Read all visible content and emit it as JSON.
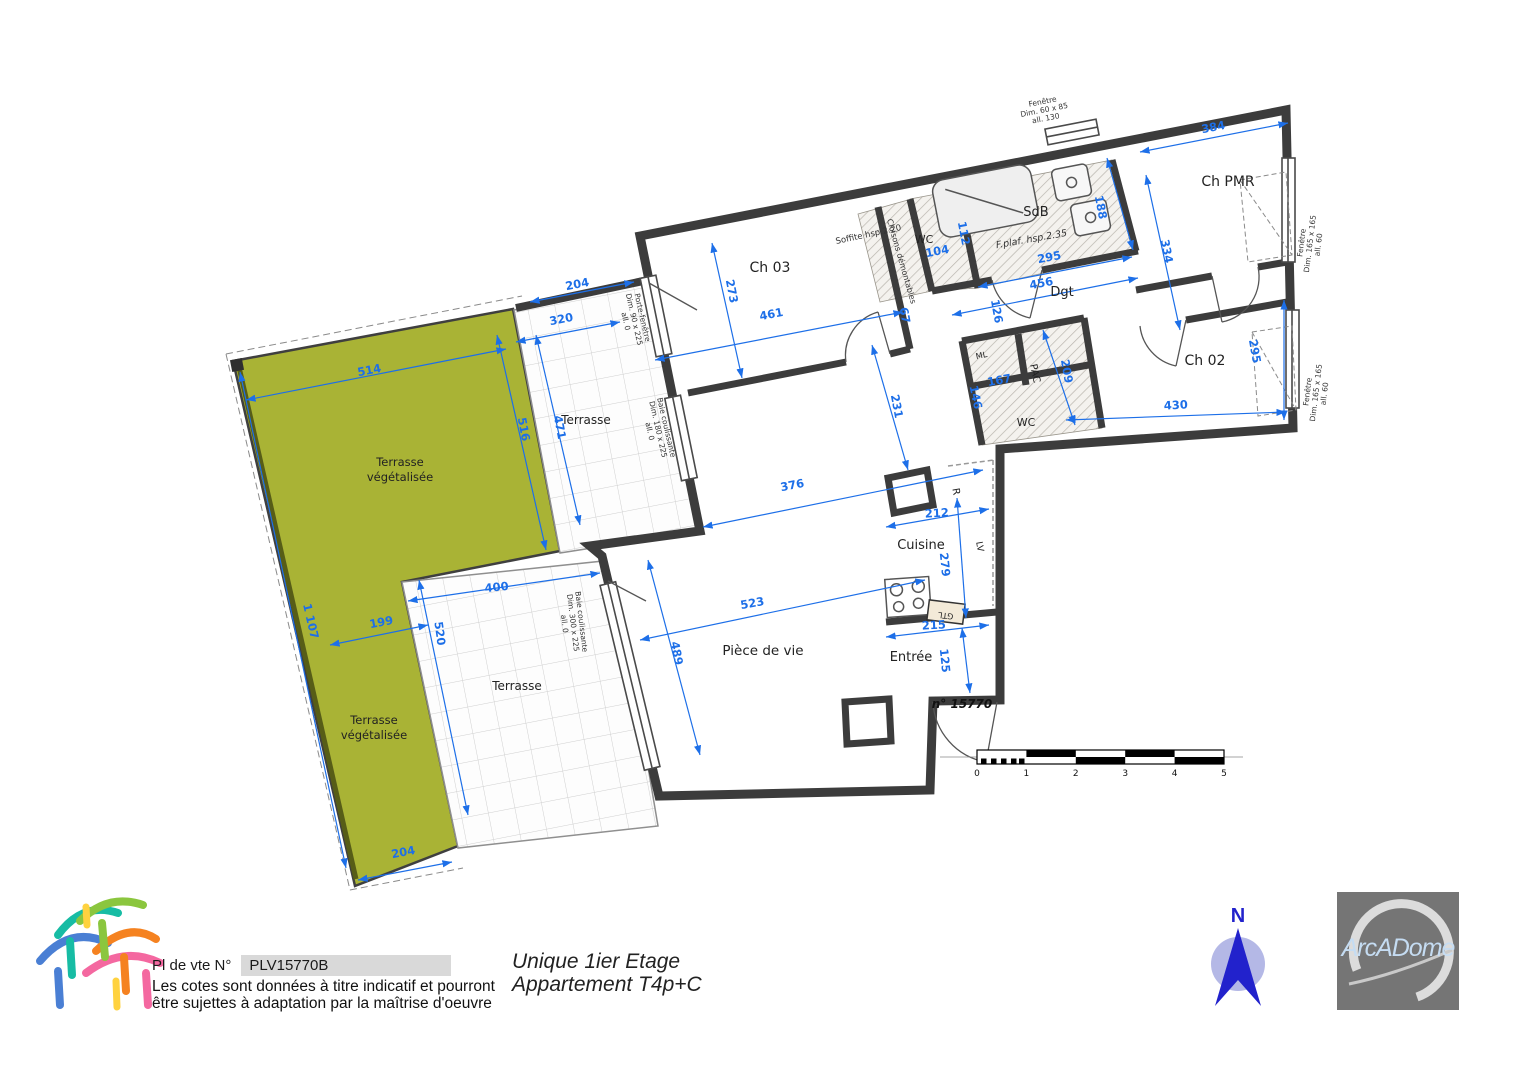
{
  "colors": {
    "dimension_blue": "#1d6fe8",
    "wall_dark": "#3c3c3c",
    "terrace_green": "#a9b335",
    "logo_gray": "#757575"
  },
  "footer": {
    "plan_ref_label": "Pl de vte N°",
    "plan_ref_value": "PLV15770B",
    "disclaimer_line1": "Les cotes sont données à titre indicatif et pourront",
    "disclaimer_line2": "être sujettes à adaptation par la  maîtrise d'oeuvre",
    "floor_title": "Unique 1ier Etage",
    "apartment_title": "Appartement  T4p+C",
    "north_label": "N",
    "brand_text": "ArcADome"
  },
  "plan": {
    "unit_number": "n° 15770",
    "rooms": [
      {
        "label": "Ch 03",
        "x": 770,
        "y": 272,
        "rot": 0,
        "size": 14
      },
      {
        "label": "Ch PMR",
        "x": 1228,
        "y": 186,
        "rot": 0,
        "size": 14
      },
      {
        "label": "Ch 02",
        "x": 1205,
        "y": 365,
        "rot": 0,
        "size": 14
      },
      {
        "label": "SdB",
        "x": 1036,
        "y": 216,
        "rot": 0,
        "size": 13
      },
      {
        "label": "Dgt",
        "x": 1062,
        "y": 296,
        "rot": 0,
        "size": 13
      },
      {
        "label": "WC",
        "x": 924,
        "y": 243,
        "rot": 0,
        "size": 11
      },
      {
        "label": "WC",
        "x": 1026,
        "y": 426,
        "rot": 0,
        "size": 11
      },
      {
        "label": "PAC",
        "x": 1032,
        "y": 374,
        "rot": 78,
        "size": 10
      },
      {
        "label": "ML",
        "x": 982,
        "y": 358,
        "rot": -12,
        "size": 8
      },
      {
        "label": "Cuisine",
        "x": 921,
        "y": 549,
        "rot": 0,
        "size": 13
      },
      {
        "label": "Pièce de vie",
        "x": 763,
        "y": 655,
        "rot": 0,
        "size": 13.5
      },
      {
        "label": "Entrée",
        "x": 911,
        "y": 661,
        "rot": 0,
        "size": 13
      },
      {
        "label": "Terrasse",
        "x": 586,
        "y": 424,
        "rot": 0,
        "size": 12
      },
      {
        "label": "Terrasse",
        "x": 517,
        "y": 690,
        "rot": 0,
        "size": 12
      },
      {
        "label": "Terrasse",
        "x": 400,
        "y": 466,
        "rot": 0,
        "size": 11.5
      },
      {
        "label": "végétalisée",
        "x": 400,
        "y": 481,
        "rot": 0,
        "size": 11.5
      },
      {
        "label": "Terrasse",
        "x": 374,
        "y": 724,
        "rot": 0,
        "size": 11.5
      },
      {
        "label": "végétalisée",
        "x": 374,
        "y": 739,
        "rot": 0,
        "size": 11.5
      },
      {
        "label": "R",
        "x": 953,
        "y": 492,
        "rot": 80,
        "size": 10
      },
      {
        "label": "LV",
        "x": 977,
        "y": 547,
        "rot": 80,
        "size": 9
      },
      {
        "label": "GTL",
        "x": 946,
        "y": 613,
        "rot": 187,
        "size": 8
      }
    ],
    "dimensions": [
      {
        "label": "384",
        "x": 1214,
        "y": 131,
        "rot": -11,
        "line": [
          1140,
          152,
          1288,
          123
        ]
      },
      {
        "label": "334",
        "x": 1163,
        "y": 252,
        "rot": 79,
        "line": [
          1146,
          175,
          1180,
          330
        ]
      },
      {
        "label": "295",
        "x": 1251,
        "y": 352,
        "rot": 80,
        "line": [
          1284,
          300,
          1284,
          420
        ]
      },
      {
        "label": "430",
        "x": 1176,
        "y": 409,
        "rot": -3,
        "line": [
          1066,
          420,
          1286,
          412
        ]
      },
      {
        "label": "209",
        "x": 1063,
        "y": 372,
        "rot": 80,
        "line": [
          1043,
          330,
          1075,
          425
        ]
      },
      {
        "label": "167",
        "x": 1000,
        "y": 384,
        "rot": -10,
        "line": null
      },
      {
        "label": "146",
        "x": 972,
        "y": 398,
        "rot": 78,
        "line": null
      },
      {
        "label": "456",
        "x": 1042,
        "y": 287,
        "rot": -11,
        "line": [
          952,
          315,
          1138,
          278
        ]
      },
      {
        "label": "126",
        "x": 993,
        "y": 312,
        "rot": 80,
        "line": null
      },
      {
        "label": "295",
        "x": 1050,
        "y": 261,
        "rot": -11,
        "line": [
          978,
          287,
          1132,
          257
        ]
      },
      {
        "label": "188",
        "x": 1097,
        "y": 208,
        "rot": 79,
        "line": [
          1107,
          158,
          1133,
          250
        ]
      },
      {
        "label": "104",
        "x": 938,
        "y": 255,
        "rot": -11,
        "line": null
      },
      {
        "label": "112",
        "x": 960,
        "y": 234,
        "rot": 79,
        "line": null
      },
      {
        "label": "67",
        "x": 901,
        "y": 316,
        "rot": 79,
        "line": null
      },
      {
        "label": "461",
        "x": 772,
        "y": 318,
        "rot": -11,
        "line": [
          655,
          360,
          903,
          312
        ]
      },
      {
        "label": "273",
        "x": 728,
        "y": 292,
        "rot": 79,
        "line": [
          712,
          243,
          742,
          378
        ]
      },
      {
        "label": "231",
        "x": 893,
        "y": 407,
        "rot": 79,
        "line": [
          872,
          345,
          908,
          470
        ]
      },
      {
        "label": "376",
        "x": 793,
        "y": 489,
        "rot": -11,
        "line": [
          703,
          527,
          983,
          470
        ]
      },
      {
        "label": "212",
        "x": 937,
        "y": 517,
        "rot": -3,
        "line": [
          886,
          527,
          989,
          509
        ]
      },
      {
        "label": "279",
        "x": 941,
        "y": 565,
        "rot": 84,
        "line": [
          957,
          498,
          966,
          618
        ]
      },
      {
        "label": "523",
        "x": 753,
        "y": 607,
        "rot": -10,
        "line": [
          640,
          640,
          925,
          580
        ]
      },
      {
        "label": "489",
        "x": 673,
        "y": 654,
        "rot": 79,
        "line": [
          648,
          560,
          700,
          755
        ]
      },
      {
        "label": "215",
        "x": 934,
        "y": 629,
        "rot": -3,
        "line": [
          886,
          637,
          989,
          625
        ]
      },
      {
        "label": "125",
        "x": 941,
        "y": 661,
        "rot": 84,
        "line": [
          962,
          628,
          970,
          693
        ]
      },
      {
        "label": "204",
        "x": 578,
        "y": 288,
        "rot": -11,
        "line": [
          530,
          302,
          634,
          282
        ]
      },
      {
        "label": "320",
        "x": 562,
        "y": 323,
        "rot": -11,
        "line": [
          516,
          342,
          620,
          322
        ]
      },
      {
        "label": "471",
        "x": 556,
        "y": 428,
        "rot": 79,
        "line": [
          536,
          335,
          580,
          525
        ]
      },
      {
        "label": "514",
        "x": 370,
        "y": 374,
        "rot": -11,
        "line": [
          246,
          400,
          506,
          349
        ]
      },
      {
        "label": "516",
        "x": 520,
        "y": 430,
        "rot": 79,
        "line": [
          497,
          335,
          546,
          550
        ]
      },
      {
        "label": "1 107",
        "x": 307,
        "y": 622,
        "rot": 77,
        "line": [
          240,
          372,
          346,
          868
        ]
      },
      {
        "label": "199",
        "x": 382,
        "y": 626,
        "rot": -11,
        "line": [
          330,
          645,
          428,
          625
        ]
      },
      {
        "label": "400",
        "x": 497,
        "y": 591,
        "rot": -6,
        "line": [
          408,
          601,
          600,
          573
        ]
      },
      {
        "label": "520",
        "x": 436,
        "y": 634,
        "rot": 82,
        "line": [
          419,
          580,
          468,
          815
        ]
      },
      {
        "label": "204",
        "x": 404,
        "y": 856,
        "rot": -11,
        "line": [
          358,
          880,
          452,
          862
        ]
      }
    ],
    "notes": [
      {
        "label": "Soffite hsp.2.20",
        "x": 869,
        "y": 237,
        "rot": -12,
        "size": 8.5
      },
      {
        "label": "Cloisons démontables",
        "x": 899,
        "y": 262,
        "rot": 74,
        "size": 8
      },
      {
        "label": "F.plaf. hsp.2.35",
        "x": 1032,
        "y": 242,
        "rot": -10,
        "size": 9.5,
        "italic": true
      }
    ],
    "window_specs": [
      {
        "lines": [
          "Fenêtre",
          "Dim. 60 x 85",
          "all.    130"
        ],
        "x": 1043,
        "y": 104,
        "rot": -11
      },
      {
        "lines": [
          "Fenêtre",
          "Dim. 165 x 165",
          "all.    60"
        ],
        "x": 1304,
        "y": 243,
        "rot": -83
      },
      {
        "lines": [
          "Fenêtre",
          "Dim. 165 x 165",
          "all.    60"
        ],
        "x": 1310,
        "y": 392,
        "rot": -83
      },
      {
        "lines": [
          "Porte-fenêtre",
          "Dim. 90 x 225",
          "all.    0"
        ],
        "x": 640,
        "y": 318,
        "rot": 77
      },
      {
        "lines": [
          "Baie coulissante",
          "Dim. 180 x 225",
          "all.    0"
        ],
        "x": 664,
        "y": 428,
        "rot": 77
      },
      {
        "lines": [
          "Baie coulissante",
          "Dim. 300 x 225",
          "all.    0"
        ],
        "x": 579,
        "y": 622,
        "rot": 83
      }
    ],
    "scale_bar": {
      "labels": [
        "0",
        "1",
        "2",
        "3",
        "4",
        "5"
      ]
    }
  }
}
